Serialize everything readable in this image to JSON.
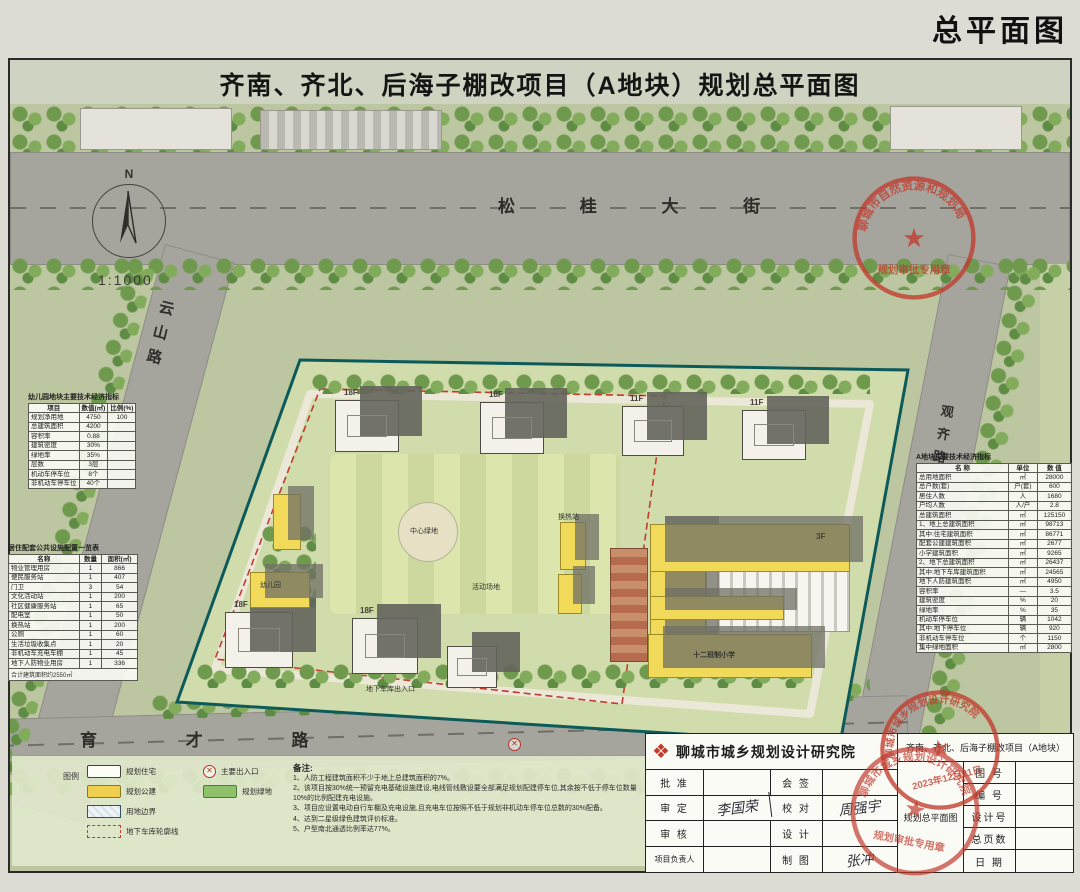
{
  "page": {
    "corner_title": "总平面图"
  },
  "sheet": {
    "title": "齐南、齐北、后海子棚改项目（A地块）规划总平面图"
  },
  "compass": {
    "north": "N",
    "scale": "1:1000"
  },
  "roads": {
    "north": "松 桂 大 街",
    "west": "云山路",
    "south": "育 才 路",
    "east": "观齐路"
  },
  "map_labels": {
    "school": "十二班制小学",
    "school_floors": "3F",
    "tower1": "18F",
    "tower2": "18F",
    "tower3": "11F",
    "tower4": "11F",
    "tower5": "18F",
    "tower6": "18F",
    "kindergarten": "幼儿园",
    "heat_station": "换热站",
    "central_green": "中心绿地",
    "activity": "活动场地",
    "garage_entry": "地下车库出入口",
    "entry_glyph": "✕"
  },
  "kindergarten_table": {
    "title": "幼儿园地块主要技术经济指标",
    "headers": [
      "项目",
      "数值(㎡)",
      "比例(%)"
    ],
    "rows": [
      [
        "规划净用地",
        "4750",
        "100"
      ],
      [
        "总建筑面积",
        "4200",
        ""
      ],
      [
        "容积率",
        "0.88",
        ""
      ],
      [
        "建筑密度",
        "30%",
        ""
      ],
      [
        "绿地率",
        "35%",
        ""
      ],
      [
        "层数",
        "3层",
        ""
      ],
      [
        "机动车停车位",
        "8个",
        ""
      ],
      [
        "非机动车停车位",
        "40个",
        ""
      ]
    ]
  },
  "facilities_table": {
    "title": "居住配套公共设施配置一览表",
    "headers": [
      "名称",
      "数量",
      "面积(㎡)"
    ],
    "rows": [
      [
        "物业管理用房",
        "1",
        "866"
      ],
      [
        "便民服务站",
        "1",
        "407"
      ],
      [
        "门卫",
        "3",
        "54"
      ],
      [
        "文化活动站",
        "1",
        "200"
      ],
      [
        "社区健康服务站",
        "1",
        "65"
      ],
      [
        "配电室",
        "1",
        "50"
      ],
      [
        "换热站",
        "1",
        "200"
      ],
      [
        "公厕",
        "1",
        "60"
      ],
      [
        "生活垃圾收集点",
        "1",
        "20"
      ],
      [
        "非机动车充电车棚",
        "1",
        "45"
      ],
      [
        "地下人防物业用房",
        "1",
        "336"
      ]
    ],
    "footer": "合计建筑面积约2550㎡"
  },
  "indicators_table": {
    "title": "A地块主要技术经济指标",
    "headers": [
      "名  称",
      "单位",
      "数  值"
    ],
    "rows": [
      [
        "总用地面积",
        "㎡",
        "28000"
      ],
      [
        "总户数(套)",
        "户(套)",
        "600"
      ],
      [
        "居住人数",
        "人",
        "1680"
      ],
      [
        "户均人数",
        "人/户",
        "2.8"
      ],
      [
        "总建筑面积",
        "㎡",
        "125150"
      ],
      [
        "1、地上总建筑面积",
        "㎡",
        "98713"
      ],
      [
        "其中:住宅建筑面积",
        "㎡",
        "86771"
      ],
      [
        "配套公建建筑面积",
        "㎡",
        "2677"
      ],
      [
        "小学建筑面积",
        "㎡",
        "9265"
      ],
      [
        "2、地下总建筑面积",
        "㎡",
        "26437"
      ],
      [
        "其中:地下车库建筑面积",
        "㎡",
        "24565"
      ],
      [
        "地下人防建筑面积",
        "㎡",
        "4950"
      ],
      [
        "容积率",
        "—",
        "3.5"
      ],
      [
        "建筑密度",
        "%",
        "20"
      ],
      [
        "绿地率",
        "%",
        "35"
      ],
      [
        "机动车停车位",
        "辆",
        "1042"
      ],
      [
        "其中:地下停车位",
        "辆",
        "920"
      ],
      [
        "非机动车停车位",
        "个",
        "1150"
      ],
      [
        "集中绿地面积",
        "㎡",
        "2800"
      ]
    ]
  },
  "legend": {
    "label": "图例",
    "items": [
      {
        "label": "规划住宅"
      },
      {
        "label": "规划公建"
      },
      {
        "label": "用地边界"
      },
      {
        "label": "地下车库轮廓线"
      },
      {
        "label": "主要出入口"
      },
      {
        "label": "规划绿地"
      }
    ]
  },
  "notes": {
    "title": "备注:",
    "lines": [
      "1、人防工程建筑面积不少于地上总建筑面积的7%。",
      "2、该项目按30%统一预留充电基础设施建设,电线管线敷设要全部满足规划配建停车位,其余按不低于停车位数量10%的比例配建充电设施。",
      "3、项目应设置电动自行车棚及充电设施,且充电车位按照不低于规划非机动车停车位总数的30%配备。",
      "4、达到二星级绿色建筑评价标准。",
      "5、户型南北通透比例率达77%。"
    ]
  },
  "title_block": {
    "institute": "聊城市城乡规划设计研究院",
    "rows": [
      {
        "l1": "批 准",
        "v1": "",
        "l2": "会 签",
        "v2": ""
      },
      {
        "l1": "审 定",
        "v1": "李国荣",
        "l2": "校 对",
        "v2": "周强宇"
      },
      {
        "l1": "审 核",
        "v1": "",
        "l2": "设 计",
        "v2": ""
      },
      {
        "l1": "项目负责人",
        "v1": "",
        "l2": "制 图",
        "v2": "张冲"
      }
    ],
    "project_name": "齐南、齐北、后海子棚改项目（A地块）",
    "drawing_name": "规划总平面图",
    "fields": [
      {
        "label": "图 号",
        "value": ""
      },
      {
        "label": "编 号",
        "value": ""
      },
      {
        "label": "设计号",
        "value": ""
      },
      {
        "label": "总页数",
        "value": ""
      },
      {
        "label": "日 期",
        "value": ""
      }
    ]
  },
  "stamps": {
    "bureau_arc": "聊城市自然资源和规划局",
    "bureau_line": "规划审批专用章",
    "institute_arc": "聊城市城乡规划设计研究院",
    "institute_date": "2023年12月21日"
  },
  "colors": {
    "boundary_teal": "#0d5a5a",
    "garage_red": "#c23b2e",
    "residential_white": "#f3f1ea",
    "public_yellow": "#f1d95a",
    "green_space": "#8fc06a",
    "stamp_red": "#c23b2e"
  }
}
